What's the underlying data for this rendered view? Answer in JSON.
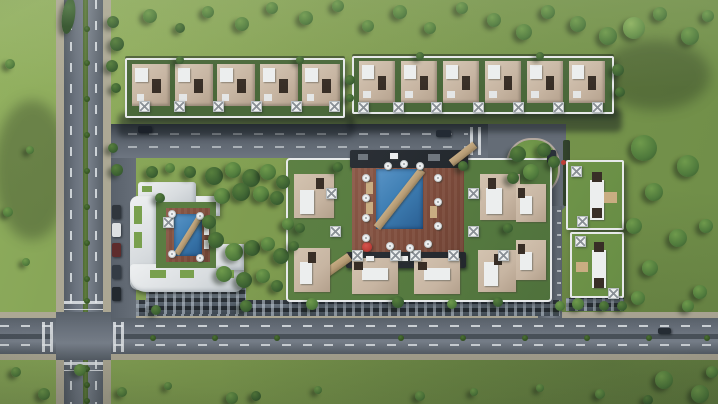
{
  "scene": {
    "type": "aerial-3d-architectural-render",
    "subject": "Residential compound master plan, top-down bird's-eye view",
    "description": "3D rendering of a gated residential compound: two north rows of townhouses with rooftop pergolas, a C-shaped white apartment building with a courtyard pool at the west, a central apartment cluster wrapped around a large blue swimming pool crossed by a diagonal walkway with umbrellas on a terracotta deck, two square villas at the east, internal streets with parked cars and a planted traffic island, perimeter roads with dashed lane markings and planted medians, and lawns with scattered trees."
  },
  "palette": {
    "grass": "#7f9c50",
    "grassLight": "#8fae5e",
    "grassDark": "#5f7c3e",
    "asphalt": "#6b737e",
    "laneMark": "#d8dde1",
    "sidewalk": "#b3a89f",
    "roofBeige": "#c7b5a2",
    "roofWhite": "#e7e9ea",
    "skylight": "#382e26",
    "poolBlue": "#3f7fb4",
    "poolDeep": "#2a5f93",
    "deckTerracotta": "#7c4b3b",
    "walkwayTan": "#b49a74",
    "treeDark": "#3c6132",
    "treeMid": "#4f7a3c",
    "treeLight": "#648f48",
    "hedge": "#2f3d2a",
    "facade": "#3f4852",
    "accentRed": "#bd3d38"
  },
  "counts": {
    "townhouse_units_north_west_row": 5,
    "townhouse_units_north_east_row": 6,
    "east_villas": 2,
    "swimming_pools": 2,
    "roof_pergolas": 27,
    "pool_umbrellas": 17,
    "red_umbrellas": 1,
    "cars_moving": 4,
    "cars_parked": 5
  }
}
